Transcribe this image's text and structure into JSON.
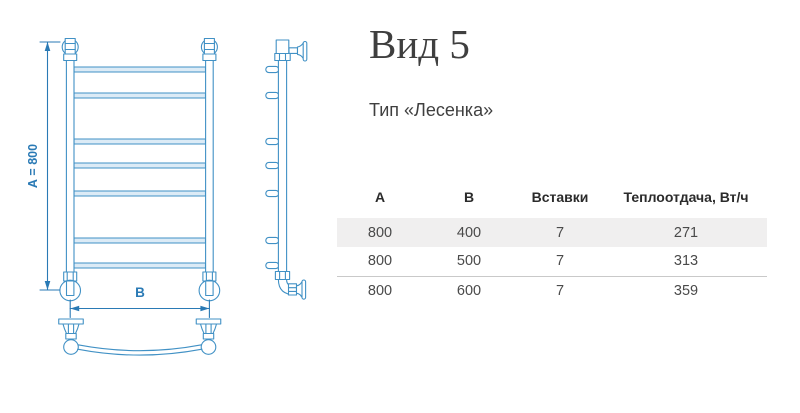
{
  "title": "Вид 5",
  "subtitle": "Тип «Лесенка»",
  "drawing": {
    "dim_a_label": "А = 800",
    "dim_b_label": "В",
    "line_color": "#4191c5",
    "dim_color": "#2a7ab5",
    "rung_fill": "#dcebf6"
  },
  "table": {
    "columns": [
      "А",
      "В",
      "Вставки",
      "Теплоотдача, Вт/ч"
    ],
    "rows": [
      [
        "800",
        "400",
        "7",
        "271"
      ],
      [
        "800",
        "500",
        "7",
        "313"
      ],
      [
        "800",
        "600",
        "7",
        "359"
      ]
    ]
  },
  "colors": {
    "stripe": "#f0efef",
    "border": "#c9c9c9",
    "title": "#3f3f3f",
    "cell_text": "#4a4a4a"
  }
}
